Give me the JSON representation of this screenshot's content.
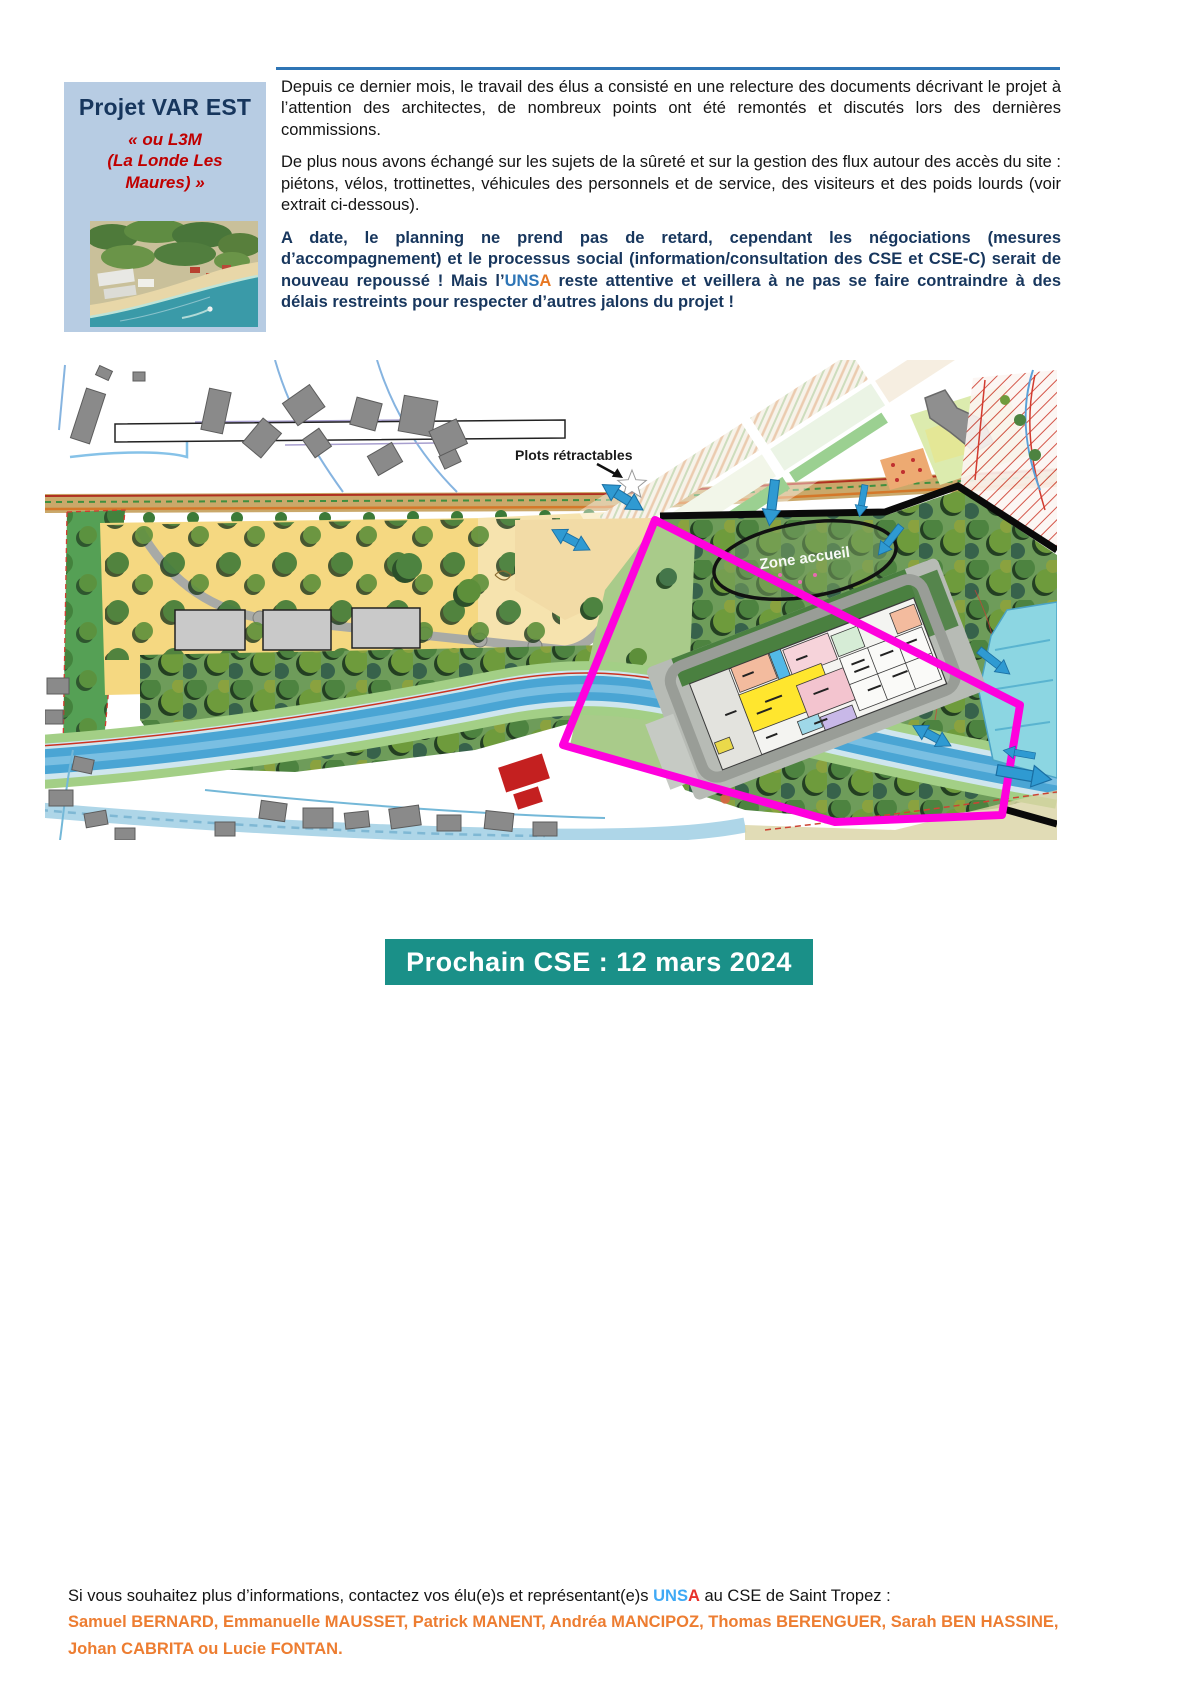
{
  "project_box": {
    "title": "Projet VAR EST",
    "subtitle_lines": [
      "« ou L3M",
      "(La Londe Les",
      "Maures) »"
    ],
    "photo_alt": "aerial-photo-coastline"
  },
  "paragraphs": {
    "p1": "Depuis ce dernier mois, le travail des élus a consisté en une relecture des documents décrivant le projet à l’attention des architectes, de nombreux points ont été remontés et discutés lors des dernières commissions.",
    "p2": "De plus nous avons échangé sur les sujets de la sûreté et sur la gestion des flux autour des accès du site : piétons, vélos, trottinettes, véhicules des personnels et de service, des visiteurs et des poids lourds (voir extrait ci-dessous).",
    "p3_before": "A date, le planning ne prend pas de retard, cependant les négociations (mesures d’accompagnement) et le processus social (information/consultation des CSE et CSE-C) serait de nouveau repoussé ! Mais l’",
    "p3_unsa_blue": "UNS",
    "p3_unsa_orange": "A",
    "p3_after": " reste attentive et veillera à ne pas se faire contraindre à des délais restreints pour respecter d’autres jalons du projet !"
  },
  "map": {
    "labels": {
      "plots": "Plots rétractables",
      "zone_accueil": "Zone accueil"
    }
  },
  "banner": {
    "text": "Prochain CSE : 12 mars 2024"
  },
  "footer": {
    "line1_before": "Si vous souhaitez plus d’informations, contactez vos élu(e)s et représentant(e)s ",
    "unsa_blue": "UNS",
    "unsa_red": "A",
    "line1_after": " au CSE de Saint Tropez :",
    "names": "Samuel BERNARD, Emmanuelle MAUSSET, Patrick MANENT, Andréa MANCIPOZ, Thomas BERENGUER, Sarah BEN HASSINE, Johan CABRITA ou Lucie FONTAN."
  },
  "colors": {
    "rule_blue": "#2e75b5",
    "box_bg": "#b7cce3",
    "title_blue": "#17365d",
    "subtitle_red": "#c00000",
    "p3_blue": "#17365d",
    "unsa_blue": "#2e75b6",
    "unsa_orange": "#e87722",
    "banner_teal": "#1a9088",
    "footer_orange": "#ed7d31",
    "footer_unsa_blue": "#3fa9f5",
    "footer_unsa_red": "#e8312a",
    "boundary_magenta": "#ff00dd",
    "flow_arrow_blue": "#2f9ad2"
  }
}
